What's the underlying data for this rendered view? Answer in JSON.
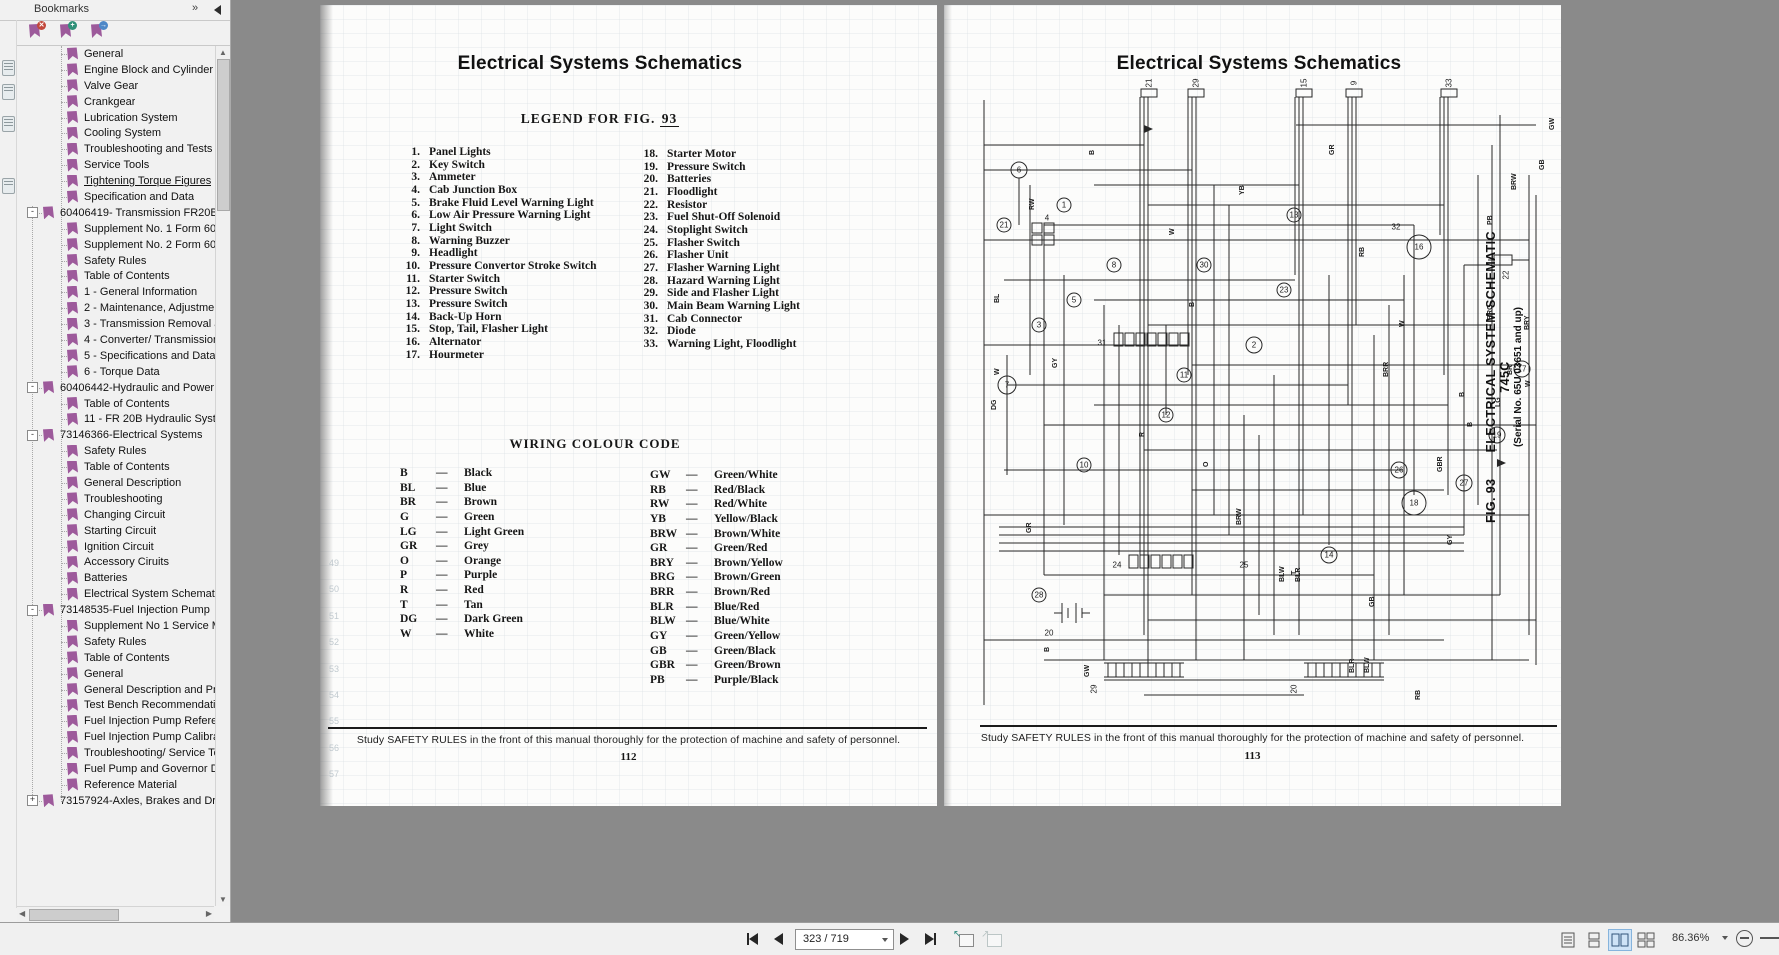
{
  "sidebar": {
    "title": "Bookmarks",
    "expand_glyph": "»",
    "items": [
      {
        "label": "General",
        "level": 1
      },
      {
        "label": "Engine Block and Cylinder Head",
        "level": 1
      },
      {
        "label": "Valve Gear",
        "level": 1
      },
      {
        "label": "Crankgear",
        "level": 1
      },
      {
        "label": "Lubrication System",
        "level": 1
      },
      {
        "label": "Cooling System",
        "level": 1
      },
      {
        "label": "Troubleshooting and Tests",
        "level": 1
      },
      {
        "label": "Service Tools",
        "level": 1
      },
      {
        "label": "Tightening Torque Figures",
        "level": 1,
        "active": true
      },
      {
        "label": "Specification and Data",
        "level": 1
      },
      {
        "label": "60406419- Transmission FR20B, FR",
        "level": 0,
        "expand": "-"
      },
      {
        "label": "Supplement No. 1 Form 604.06",
        "level": 1
      },
      {
        "label": "Supplement No. 2 Form 604.06",
        "level": 1
      },
      {
        "label": "Safety Rules",
        "level": 1
      },
      {
        "label": "Table of Contents",
        "level": 1
      },
      {
        "label": "1 - General Information",
        "level": 1
      },
      {
        "label": "2 - Maintenance, Adjustments a",
        "level": 1
      },
      {
        "label": "3 - Transmission Removal and In",
        "level": 1
      },
      {
        "label": "4 - Converter/ Transmission Uni",
        "level": 1
      },
      {
        "label": "5 - Specifications and Data",
        "level": 1
      },
      {
        "label": "6 - Torque Data",
        "level": 1
      },
      {
        "label": "60406442-Hydraulic and Power Ste",
        "level": 0,
        "expand": "-"
      },
      {
        "label": "Table of Contents",
        "level": 1
      },
      {
        "label": "11 - FR 20B Hydraulic System",
        "level": 1
      },
      {
        "label": "73146366-Electrical Systems",
        "level": 0,
        "expand": "-"
      },
      {
        "label": "Safety Rules",
        "level": 1
      },
      {
        "label": "Table of Contents",
        "level": 1
      },
      {
        "label": "General Description",
        "level": 1
      },
      {
        "label": "Troubleshooting",
        "level": 1
      },
      {
        "label": "Changing Circuit",
        "level": 1
      },
      {
        "label": "Starting Circuit",
        "level": 1
      },
      {
        "label": "Ignition Circuit",
        "level": 1
      },
      {
        "label": "Accessory Ciruits",
        "level": 1
      },
      {
        "label": "Batteries",
        "level": 1
      },
      {
        "label": "Electrical System Schematics",
        "level": 1
      },
      {
        "label": "73148535-Fuel Injection Pump",
        "level": 0,
        "expand": "-"
      },
      {
        "label": "Supplement No 1 Service Manu",
        "level": 1
      },
      {
        "label": "Safety Rules",
        "level": 1
      },
      {
        "label": "Table of Contents",
        "level": 1
      },
      {
        "label": "General",
        "level": 1
      },
      {
        "label": "General Description and Principl",
        "level": 1
      },
      {
        "label": "Test Bench Recommendations",
        "level": 1
      },
      {
        "label": "Fuel Injection Pump Reference,",
        "level": 1
      },
      {
        "label": "Fuel Injection Pump Calibration",
        "level": 1
      },
      {
        "label": "Troubleshooting/ Service Tools",
        "level": 1
      },
      {
        "label": "Fuel Pump and Governor Disass",
        "level": 1
      },
      {
        "label": "Reference Material",
        "level": 1
      },
      {
        "label": "73157924-Axles, Brakes and Drive",
        "level": 0,
        "expand": "+"
      }
    ]
  },
  "left_page": {
    "title": "Electrical Systems Schematics",
    "legend_heading": "LEGEND FOR FIG.",
    "legend_fig_no": "93",
    "legend_col1": [
      {
        "n": "1.",
        "t": "Panel Lights"
      },
      {
        "n": "2.",
        "t": "Key Switch"
      },
      {
        "n": "3.",
        "t": "Ammeter"
      },
      {
        "n": "4.",
        "t": "Cab Junction Box"
      },
      {
        "n": "5.",
        "t": "Brake Fluid Level Warning Light"
      },
      {
        "n": "6.",
        "t": "Low Air Pressure Warning Light"
      },
      {
        "n": "7.",
        "t": "Light Switch"
      },
      {
        "n": "8.",
        "t": "Warning Buzzer"
      },
      {
        "n": "9.",
        "t": "Headlight"
      },
      {
        "n": "10.",
        "t": "Pressure Convertor Stroke Switch"
      },
      {
        "n": "11.",
        "t": "Starter Switch"
      },
      {
        "n": "12.",
        "t": "Pressure Switch"
      },
      {
        "n": "13.",
        "t": "Pressure Switch"
      },
      {
        "n": "14.",
        "t": "Back-Up Horn"
      },
      {
        "n": "15.",
        "t": "Stop, Tail, Flasher Light"
      },
      {
        "n": "16.",
        "t": "Alternator"
      },
      {
        "n": "17.",
        "t": "Hourmeter"
      }
    ],
    "legend_col2": [
      {
        "n": "18.",
        "t": "Starter Motor"
      },
      {
        "n": "19.",
        "t": "Pressure Switch"
      },
      {
        "n": "20.",
        "t": "Batteries"
      },
      {
        "n": "21.",
        "t": "Floodlight"
      },
      {
        "n": "22.",
        "t": "Resistor"
      },
      {
        "n": "23.",
        "t": "Fuel Shut-Off Solenoid"
      },
      {
        "n": "24.",
        "t": "Stoplight Switch"
      },
      {
        "n": "25.",
        "t": "Flasher Switch"
      },
      {
        "n": "26.",
        "t": "Flasher Unit"
      },
      {
        "n": "27.",
        "t": "Flasher Warning Light"
      },
      {
        "n": "28.",
        "t": "Hazard Warning Light"
      },
      {
        "n": "29.",
        "t": "Side and Flasher Light"
      },
      {
        "n": "30.",
        "t": "Main Beam Warning Light"
      },
      {
        "n": "31.",
        "t": "Cab Connector"
      },
      {
        "n": "32.",
        "t": "Diode"
      },
      {
        "n": "33.",
        "t": "Warning Light, Floodlight"
      }
    ],
    "wiring_heading": "WIRING COLOUR CODE",
    "color_col1": [
      {
        "c": "B",
        "t": "Black"
      },
      {
        "c": "BL",
        "t": "Blue"
      },
      {
        "c": "BR",
        "t": "Brown"
      },
      {
        "c": "G",
        "t": "Green"
      },
      {
        "c": "LG",
        "t": "Light Green"
      },
      {
        "c": "GR",
        "t": "Grey"
      },
      {
        "c": "O",
        "t": "Orange"
      },
      {
        "c": "P",
        "t": "Purple"
      },
      {
        "c": "R",
        "t": "Red"
      },
      {
        "c": "T",
        "t": "Tan"
      },
      {
        "c": "DG",
        "t": "Dark Green"
      },
      {
        "c": "W",
        "t": "White"
      }
    ],
    "color_col2": [
      {
        "c": "GW",
        "t": "Green/White"
      },
      {
        "c": "RB",
        "t": "Red/Black"
      },
      {
        "c": "RW",
        "t": "Red/White"
      },
      {
        "c": "YB",
        "t": "Yellow/Black"
      },
      {
        "c": "BRW",
        "t": "Brown/White"
      },
      {
        "c": "GR",
        "t": "Green/Red"
      },
      {
        "c": "BRY",
        "t": "Brown/Yellow"
      },
      {
        "c": "BRG",
        "t": "Brown/Green"
      },
      {
        "c": "BRR",
        "t": "Brown/Red"
      },
      {
        "c": "BLR",
        "t": "Blue/Red"
      },
      {
        "c": "BLW",
        "t": "Blue/White"
      },
      {
        "c": "GY",
        "t": "Green/Yellow"
      },
      {
        "c": "GB",
        "t": "Green/Black"
      },
      {
        "c": "GBR",
        "t": "Green/Brown"
      },
      {
        "c": "PB",
        "t": "Purple/Black"
      }
    ],
    "ghost_numbers": [
      "49",
      "50",
      "51",
      "52",
      "53",
      "54",
      "55",
      "56",
      "57"
    ],
    "footer_note": "Study SAFETY RULES in the front of this manual thoroughly for the protection of machine and safety of personnel.",
    "page_number": "112"
  },
  "right_page": {
    "title": "Electrical Systems Schematics",
    "fig_label": "FIG. 93",
    "fig_title": "ELECTRICAL SYSTEM SCHEMATIC 745C",
    "fig_serial": "(Serial No. 65U 03651 and up)",
    "footer_note": "Study SAFETY RULES in the front of this manual thoroughly for the protection of machine and safety of personnel.",
    "page_number": "113",
    "schematic": {
      "components": [
        {
          "n": "21",
          "x": 205,
          "y": 8,
          "r": 0,
          "rot": 1
        },
        {
          "n": "29",
          "x": 252,
          "y": 8,
          "r": 0,
          "rot": 1
        },
        {
          "n": "15",
          "x": 360,
          "y": 8,
          "r": 0,
          "rot": 1
        },
        {
          "n": "9",
          "x": 410,
          "y": 8,
          "r": 0,
          "rot": 1
        },
        {
          "n": "33",
          "x": 505,
          "y": 8,
          "r": 0,
          "rot": 1
        },
        {
          "n": "6",
          "x": 75,
          "y": 95,
          "r": 8
        },
        {
          "n": "21",
          "x": 60,
          "y": 150,
          "r": 7
        },
        {
          "n": "1",
          "x": 120,
          "y": 130,
          "r": 7
        },
        {
          "n": "8",
          "x": 170,
          "y": 190,
          "r": 7
        },
        {
          "n": "30",
          "x": 260,
          "y": 190,
          "r": 7
        },
        {
          "n": "5",
          "x": 130,
          "y": 225,
          "r": 7
        },
        {
          "n": "3",
          "x": 95,
          "y": 250,
          "r": 7
        },
        {
          "n": "13",
          "x": 350,
          "y": 140,
          "r": 7
        },
        {
          "n": "23",
          "x": 340,
          "y": 215,
          "r": 7
        },
        {
          "n": "16",
          "x": 475,
          "y": 172,
          "r": 12
        },
        {
          "n": "32",
          "x": 452,
          "y": 152,
          "r": 0
        },
        {
          "n": "22",
          "x": 562,
          "y": 200,
          "r": 0,
          "rot": 1
        },
        {
          "n": "2",
          "x": 310,
          "y": 270,
          "r": 8
        },
        {
          "n": "11",
          "x": 240,
          "y": 300,
          "r": 7
        },
        {
          "n": "7",
          "x": 63,
          "y": 310,
          "r": 9
        },
        {
          "n": "12",
          "x": 222,
          "y": 340,
          "r": 7
        },
        {
          "n": "10",
          "x": 140,
          "y": 390,
          "r": 7
        },
        {
          "n": "17",
          "x": 578,
          "y": 294,
          "r": 8
        },
        {
          "n": "19",
          "x": 553,
          "y": 360,
          "r": 8
        },
        {
          "n": "26",
          "x": 455,
          "y": 395,
          "r": 8
        },
        {
          "n": "27",
          "x": 520,
          "y": 408,
          "r": 8
        },
        {
          "n": "18",
          "x": 470,
          "y": 428,
          "r": 12
        },
        {
          "n": "14",
          "x": 385,
          "y": 480,
          "r": 8
        },
        {
          "n": "28",
          "x": 95,
          "y": 520,
          "r": 7
        },
        {
          "n": "31",
          "x": 158,
          "y": 268,
          "r": 0
        },
        {
          "n": "24",
          "x": 173,
          "y": 490,
          "r": 0
        },
        {
          "n": "25",
          "x": 300,
          "y": 490,
          "r": 0
        },
        {
          "n": "4",
          "x": 103,
          "y": 143,
          "r": 0
        },
        {
          "n": "20",
          "x": 105,
          "y": 558,
          "r": 0
        },
        {
          "n": "29",
          "x": 150,
          "y": 614,
          "r": 0,
          "rot": 1
        },
        {
          "n": "20",
          "x": 350,
          "y": 614,
          "r": 0,
          "rot": 1
        }
      ],
      "wire_labels": [
        {
          "t": "GW",
          "x": 610,
          "y": 55
        },
        {
          "t": "GB",
          "x": 600,
          "y": 95
        },
        {
          "t": "B",
          "x": 150,
          "y": 80
        },
        {
          "t": "RW",
          "x": 90,
          "y": 135
        },
        {
          "t": "YB",
          "x": 300,
          "y": 120
        },
        {
          "t": "GR",
          "x": 390,
          "y": 80
        },
        {
          "t": "W",
          "x": 230,
          "y": 160
        },
        {
          "t": "B",
          "x": 250,
          "y": 232
        },
        {
          "t": "BL",
          "x": 55,
          "y": 228
        },
        {
          "t": "GY",
          "x": 113,
          "y": 293
        },
        {
          "t": "DG",
          "x": 52,
          "y": 335
        },
        {
          "t": "GR",
          "x": 87,
          "y": 458
        },
        {
          "t": "BRW",
          "x": 297,
          "y": 450
        },
        {
          "t": "T",
          "x": 352,
          "y": 500
        },
        {
          "t": "BLW",
          "x": 340,
          "y": 507
        },
        {
          "t": "BLR",
          "x": 356,
          "y": 507
        },
        {
          "t": "PB",
          "x": 548,
          "y": 150
        },
        {
          "t": "BRG",
          "x": 548,
          "y": 245
        },
        {
          "t": "B",
          "x": 520,
          "y": 322
        },
        {
          "t": "BRW",
          "x": 572,
          "y": 115
        },
        {
          "t": "BR",
          "x": 568,
          "y": 300
        },
        {
          "t": "W",
          "x": 586,
          "y": 312
        },
        {
          "t": "LG",
          "x": 556,
          "y": 332
        },
        {
          "t": "B",
          "x": 528,
          "y": 352
        },
        {
          "t": "W",
          "x": 460,
          "y": 252
        },
        {
          "t": "GBR",
          "x": 498,
          "y": 397
        },
        {
          "t": "GY",
          "x": 508,
          "y": 470
        },
        {
          "t": "RB",
          "x": 420,
          "y": 182
        },
        {
          "t": "BRY",
          "x": 585,
          "y": 255
        },
        {
          "t": "BRR",
          "x": 444,
          "y": 302
        },
        {
          "t": "GB",
          "x": 430,
          "y": 532
        },
        {
          "t": "R",
          "x": 200,
          "y": 362
        },
        {
          "t": "O",
          "x": 264,
          "y": 392
        },
        {
          "t": "B",
          "x": 105,
          "y": 577
        },
        {
          "t": "GW",
          "x": 145,
          "y": 602
        },
        {
          "t": "BLR",
          "x": 410,
          "y": 598
        },
        {
          "t": "BLW",
          "x": 425,
          "y": 598
        },
        {
          "t": "RB",
          "x": 476,
          "y": 625
        },
        {
          "t": "W",
          "x": 55,
          "y": 300
        }
      ]
    }
  },
  "toolbar": {
    "page_value": "323 / 719",
    "zoom_value": "86.36%"
  }
}
